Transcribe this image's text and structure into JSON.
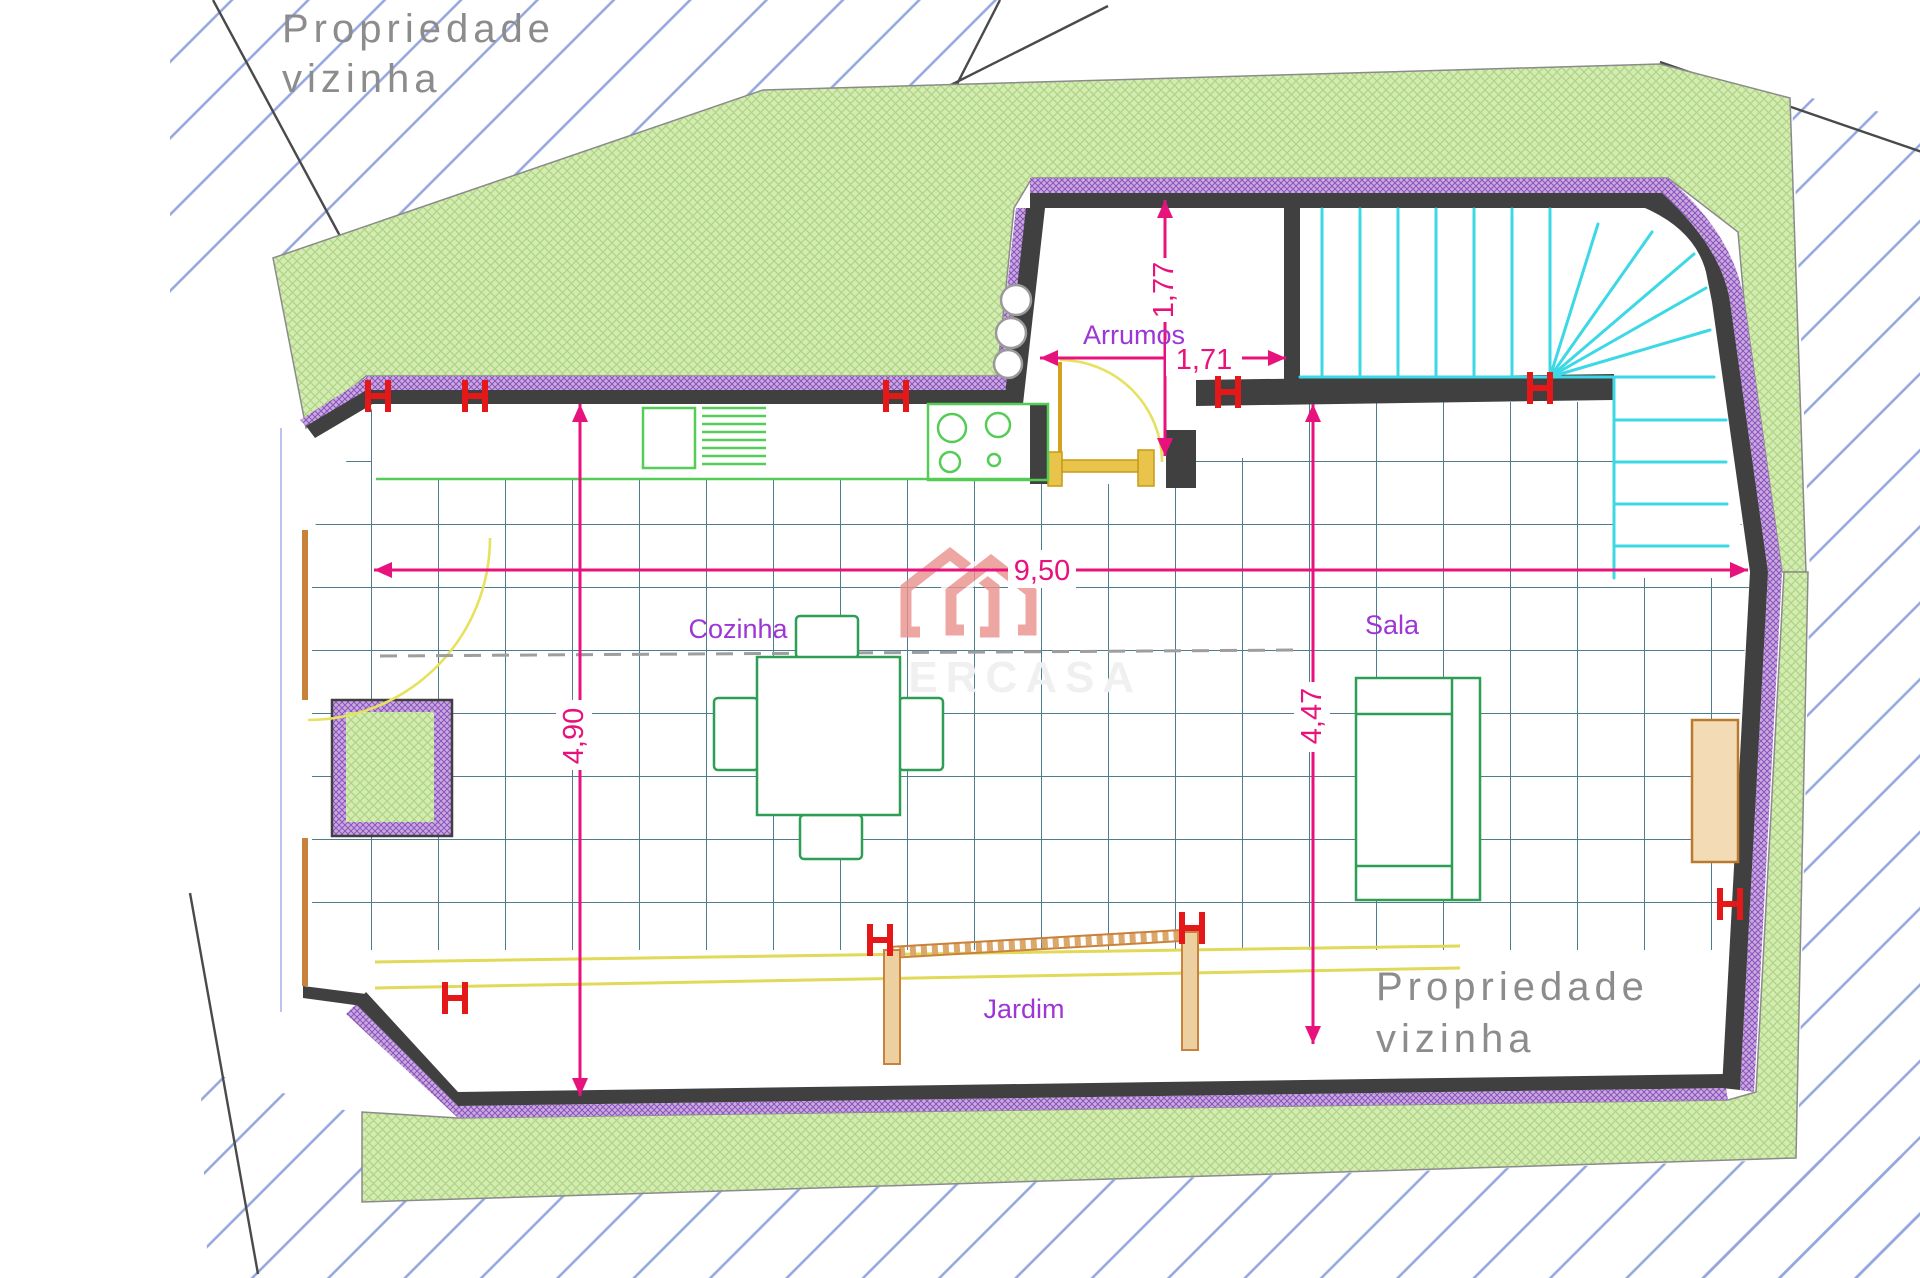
{
  "site": {
    "neighbor_line1": "Propriedade",
    "neighbor_line2": "vizinha"
  },
  "rooms": {
    "storage": "Arrumos",
    "kitchen": "Cozinha",
    "living": "Sala",
    "garden": "Jardim"
  },
  "dimensions": {
    "overall_width": "9,50",
    "kitchen_depth": "4,90",
    "living_depth": "4,47",
    "storage_depth": "1,77",
    "storage_width": "1,71"
  },
  "watermark": {
    "brand": "SUPERCASA"
  },
  "colors": {
    "wall": "#404040",
    "insulation": "#b28ad2",
    "garden_green": "#cde6ac",
    "hatch_blue": "#93a6de",
    "floor_grid": "#4d7c8d",
    "dimension_magenta": "#e8127c",
    "room_label_purple": "#9e35d6",
    "stairs_cyan": "#3cd8e6",
    "furniture_green": "#3aa055",
    "door_gold": "#d4a01e",
    "frame_orange": "#c8823c",
    "column_red": "#e41818",
    "watermark_salmon": "#e9908a",
    "neighbor_text_gray": "#8c8c8c"
  }
}
